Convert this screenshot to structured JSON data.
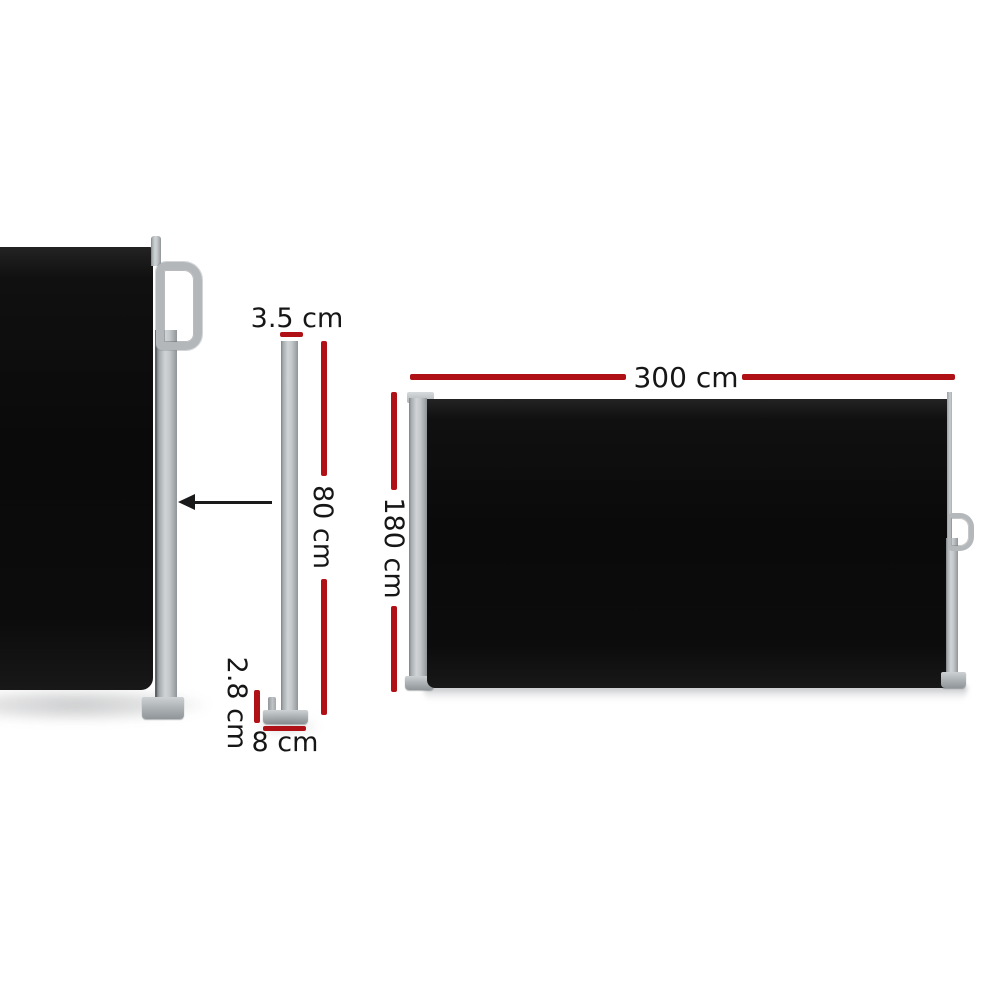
{
  "labels": {
    "post_top_width": "3.5 cm",
    "post_height": "80 cm",
    "post_base_height": "2.8 cm",
    "post_base_width": "8 cm",
    "awning_width": "300 cm",
    "awning_height": "180 cm"
  },
  "colors": {
    "dimension_line_red": "#b01116",
    "fabric_black": "#0d0d0d",
    "frame_gray_light": "#d0d4d6",
    "frame_gray_mid": "#b4b8bb",
    "frame_gray_dark": "#8e9497",
    "text": "#161616",
    "arrow": "#1a1a1a",
    "background": "#ffffff"
  },
  "icons": {
    "retract_arrow": "left-arrow",
    "grab_handle": "d-handle",
    "pull_handle": "d-handle-small"
  }
}
